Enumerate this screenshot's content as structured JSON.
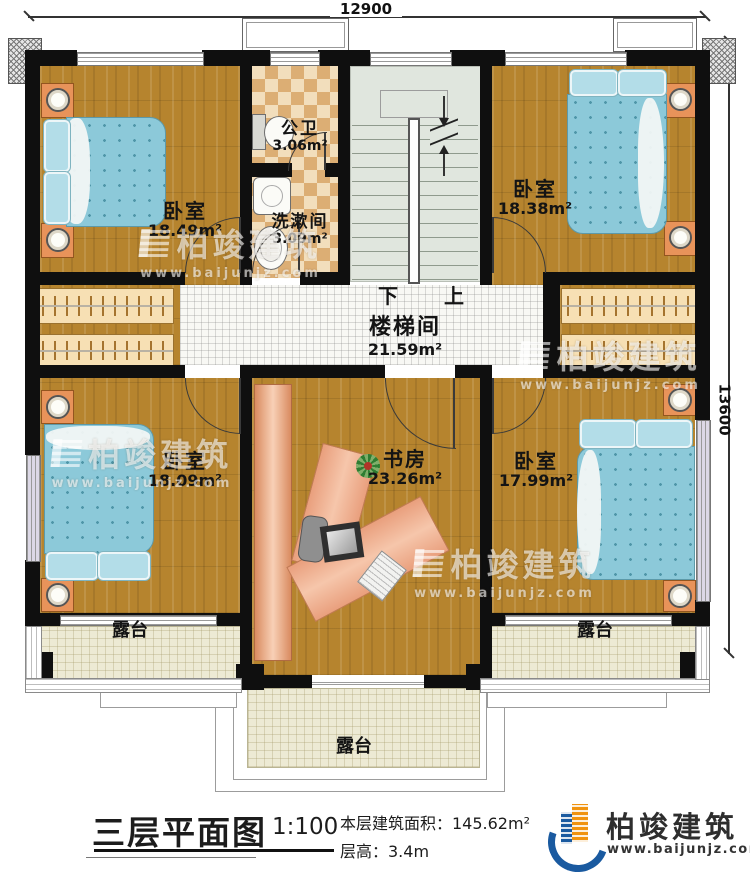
{
  "dimensions": {
    "width_label": "12900",
    "height_label": "13600"
  },
  "rooms": {
    "bedroom_tl": {
      "name": "卧室",
      "area": "18.49m²"
    },
    "bedroom_tr": {
      "name": "卧室",
      "area": "18.38m²"
    },
    "bedroom_bl": {
      "name": "卧室",
      "area": "18.09m²"
    },
    "bedroom_br": {
      "name": "卧室",
      "area": "17.99m²"
    },
    "bathroom": {
      "name": "公卫",
      "area": "3.06m²"
    },
    "washroom": {
      "name": "洗漱间",
      "area": "3.09m²"
    },
    "stairwell": {
      "name": "楼梯间",
      "area": "21.59m²"
    },
    "study": {
      "name": "书房",
      "area": "23.26m²"
    },
    "terrace_left": {
      "name": "露台"
    },
    "terrace_right": {
      "name": "露台"
    },
    "terrace_bottom": {
      "name": "露台"
    }
  },
  "stairs": {
    "down_label": "下",
    "up_label": "上"
  },
  "title_block": {
    "title": "三层平面图",
    "scale": "1:100",
    "area_line": "本层建筑面积：145.62m²",
    "floor_height_line": "层高：3.4m"
  },
  "logo": {
    "name": "柏竣建筑",
    "url": "www.baijunjz.com"
  },
  "watermark": {
    "name": "柏竣建筑",
    "url": "www.baijunjz.com"
  },
  "colors": {
    "wall": "#0f0f0f",
    "wood_floor": "#b6842e",
    "bed": "#8cc9d9",
    "bath_tile": "#f2debc",
    "stair_floor": "#e0e6de",
    "terrace_floor": "#edead4",
    "desk": "#edab89",
    "logo_blue": "#1a5aa0",
    "logo_orange": "#f0930f"
  }
}
